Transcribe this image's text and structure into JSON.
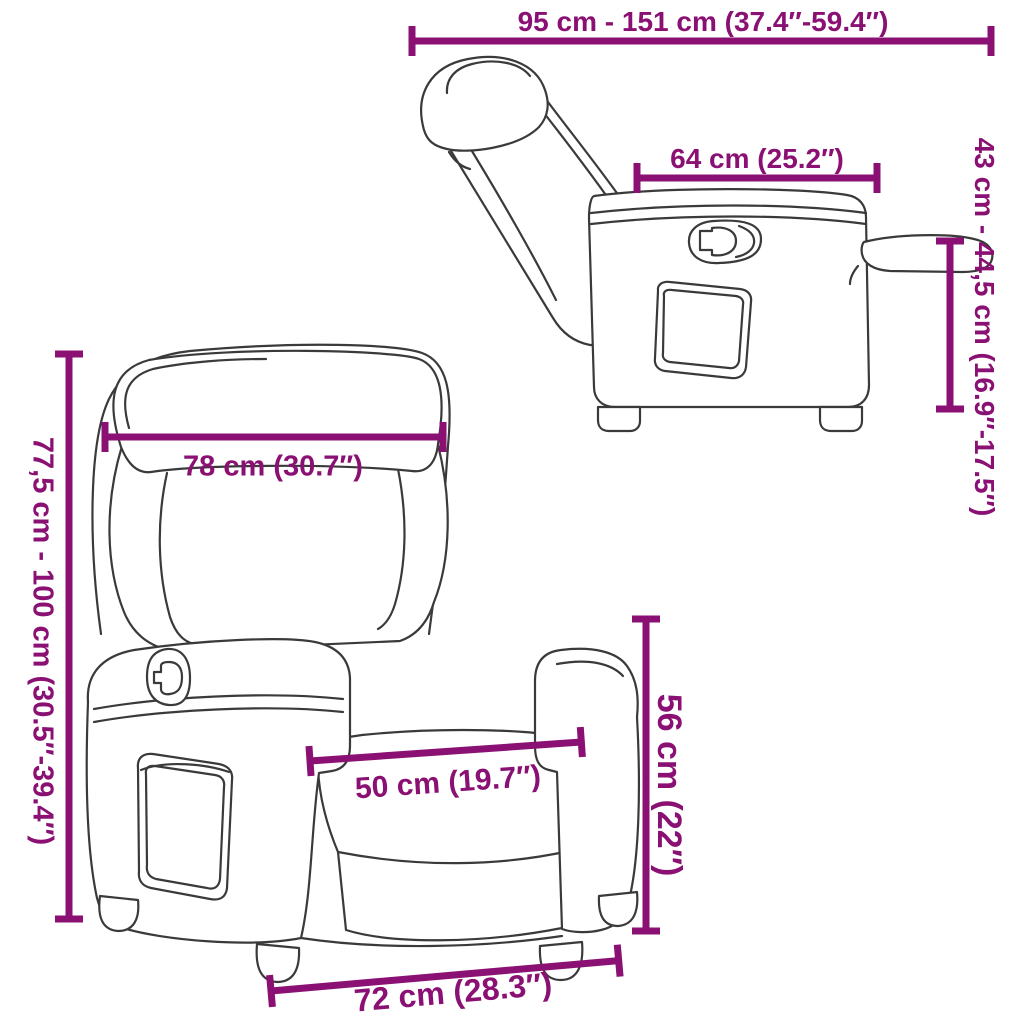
{
  "colors": {
    "dimension_accent": "#8A1173",
    "line_art": "#3A3A3A",
    "background": "#FFFFFF"
  },
  "diagram": {
    "subject": "recliner-chair-dimension-diagram",
    "views": [
      "side-view-reclined",
      "front-view"
    ],
    "dimension_labels": {
      "overall_length": "95 cm - 151 cm (37.4″-59.4″)",
      "seat_unit_depth": "64 cm (25.2″)",
      "footrest_height": "43 cm - 44,5 cm (16.9″-17.5″)",
      "backrest_height": "77,5 cm - 100 cm (30.5″-39.4″)",
      "backrest_width": "78 cm (30.7″)",
      "seat_width": "50 cm (19.7″)",
      "armrest_height": "56 cm (22″)",
      "base_width": "72 cm (28.3″)"
    }
  }
}
